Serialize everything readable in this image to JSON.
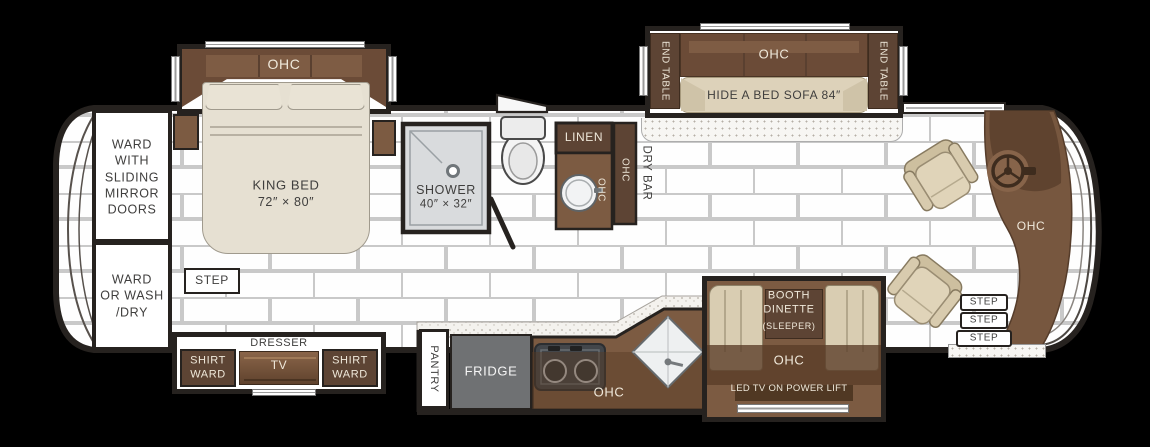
{
  "title": "RV floor plan",
  "colors": {
    "wall": "#26221f",
    "cabinet_dark": "#5d4434",
    "cabinet_mid": "#6b4b37",
    "cabinet_light": "#7c5b42",
    "fabric_tan": "#ddd2ba",
    "bed_cream": "#e6e0d2",
    "fridge_gray": "#6f7173",
    "shower_gray": "#d9dbdd",
    "floor_mortar": "#c9c9c9",
    "text_dark": "#3f3e3d",
    "text_cream": "#efe8da"
  },
  "labels": {
    "ohc": "OHC",
    "step": "STEP",
    "ward_mirror": "WARD\nWITH\nSLIDING\nMIRROR\nDOORS",
    "ward_washdry": "WARD\nOR WASH\n/DRY",
    "king_bed_line1": "KING BED",
    "king_bed_line2": "72″ × 80″",
    "dresser": "DRESSER",
    "tv": "TV",
    "shirt_ward": "SHIRT\nWARD",
    "shower_line1": "SHOWER",
    "shower_line2": "40″ × 32″",
    "linen": "LINEN",
    "dry_bar": "DRY BAR",
    "end_table": "END TABLE",
    "hide_a_bed_sofa": "HIDE A BED SOFA 84″",
    "pantry": "PANTRY",
    "fridge": "FRIDGE",
    "booth_dinette": "BOOTH\nDINETTE",
    "booth_sleeper": "(SLEEPER)",
    "led_tv": "LED TV ON POWER LIFT"
  }
}
